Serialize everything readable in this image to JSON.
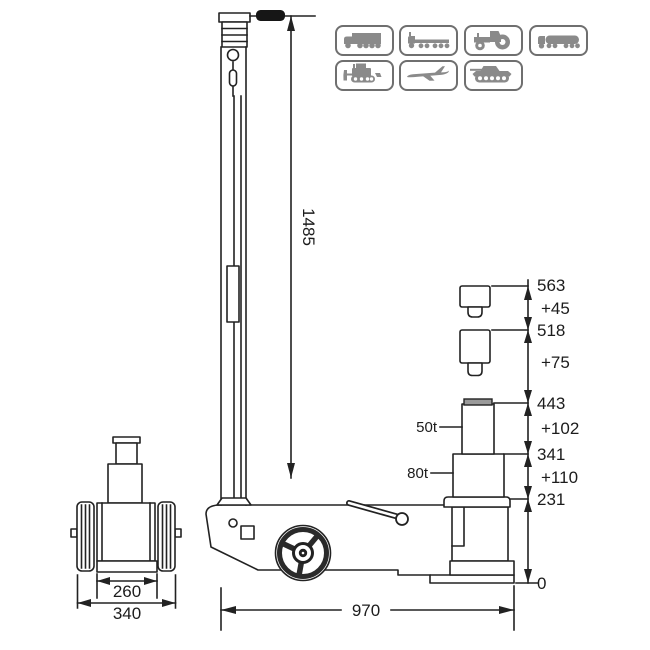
{
  "page": {
    "background": "#ffffff",
    "ink": "#222222"
  },
  "compatibility_icons": {
    "border_color": "#6f6f6f",
    "glyph_color": "#8a8a8a",
    "row1": [
      {
        "name": "box-truck"
      },
      {
        "name": "flatbed-trailer-truck"
      },
      {
        "name": "tractor"
      },
      {
        "name": "tanker-truck"
      }
    ],
    "row2": [
      {
        "name": "bulldozer"
      },
      {
        "name": "airplane"
      },
      {
        "name": "tank"
      }
    ]
  },
  "side_view": {
    "handle_height": "1485",
    "overall_length": "970",
    "stage1_label": "50t",
    "stage2_label": "80t"
  },
  "front_view": {
    "saddle_width": "260",
    "overall_width": "340"
  },
  "height_chain": {
    "h563": "563",
    "d45": "+45",
    "h518": "518",
    "d75": "+75",
    "h443": "443",
    "d102": "+102",
    "h341": "341",
    "d110": "+110",
    "h231": "231",
    "h0": "0"
  }
}
